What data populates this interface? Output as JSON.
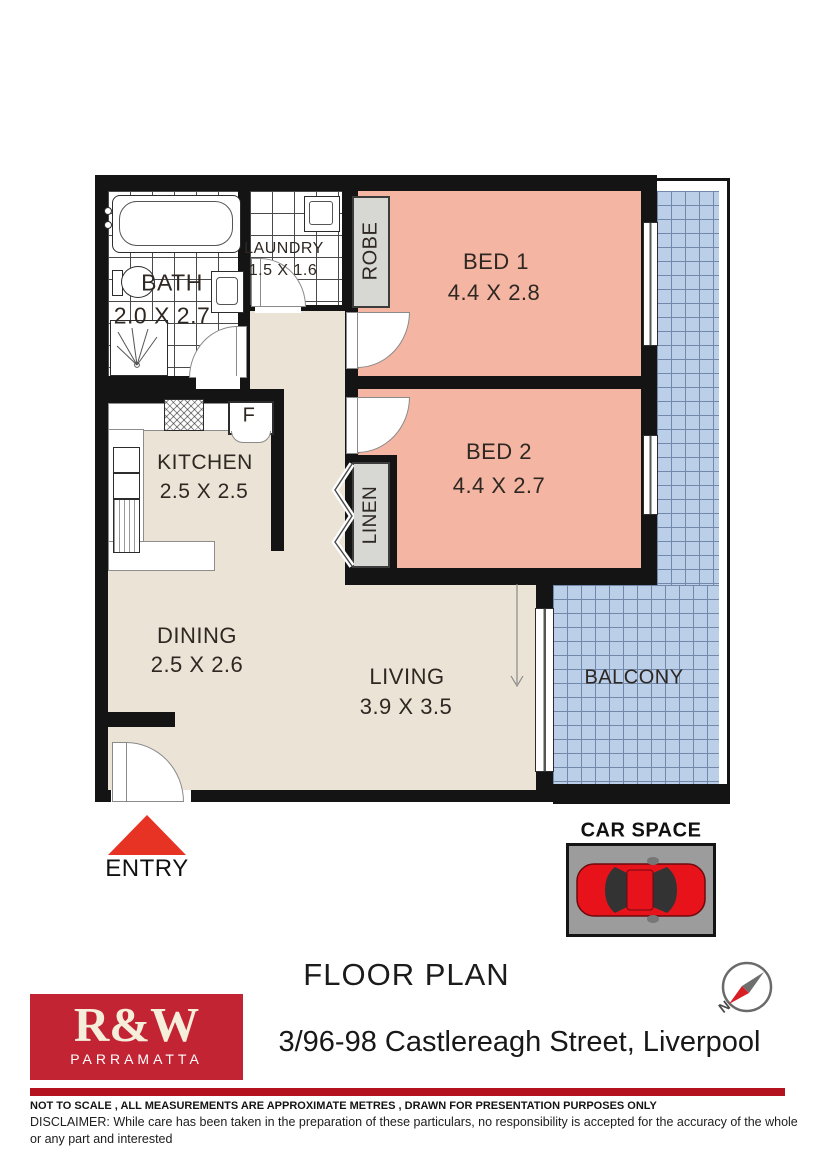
{
  "plan": {
    "rooms": {
      "bath": {
        "label": "BATH",
        "dims": "2.0 X 2.7"
      },
      "laundry": {
        "label": "LAUNDRY",
        "dims": "1.5 X 1.6"
      },
      "robe": {
        "label": "ROBE"
      },
      "bed1": {
        "label": "BED 1",
        "dims": "4.4 X 2.8"
      },
      "bed2": {
        "label": "BED 2",
        "dims": "4.4 X 2.7"
      },
      "kitchen": {
        "label": "KITCHEN",
        "dims": "2.5 X 2.5"
      },
      "linen": {
        "label": "LINEN"
      },
      "dining": {
        "label": "DINING",
        "dims": "2.5 X 2.6"
      },
      "living": {
        "label": "LIVING",
        "dims": "3.9 X 3.5"
      },
      "balcony": {
        "label": "BALCONY"
      }
    },
    "markers": {
      "entry": "ENTRY",
      "fridge": "F",
      "car_space": "CAR SPACE",
      "north": "N"
    }
  },
  "footer": {
    "title": "FLOOR PLAN",
    "address": "3/96-98 Castlereagh Street, Liverpool",
    "logo_brand": "R&W",
    "logo_office": "PARRAMATTA",
    "note": "NOT TO SCALE , ALL MEASUREMENTS ARE APPROXIMATE METRES , DRAWN FOR PRESENTATION PURPOSES ONLY",
    "disclaimer_lines": [
      "DISCLAIMER:  While care has been taken in the preparation of these particulars, no responsibility is accepted for the accuracy of the whole or any part and interested",
      "persons are advised to make their own enquiries and satisfy  themselves in all respects."
    ]
  },
  "colors": {
    "wall": "#141414",
    "floor": "#ebe4d6",
    "bedroom": "#f4b5a3",
    "balcony": "#bccfe8",
    "balcony-grid": "#7288ab",
    "tile-line": "#4a4a4a",
    "gray-box": "#d7d7d3",
    "carpark": "#9c9c9c",
    "car-red": "#e8121b",
    "triangle-red": "#e63323",
    "logo-red": "#c32433",
    "logo-text": "#f5eedb",
    "rule-red": "#b5121f",
    "label": "#2e2722"
  }
}
